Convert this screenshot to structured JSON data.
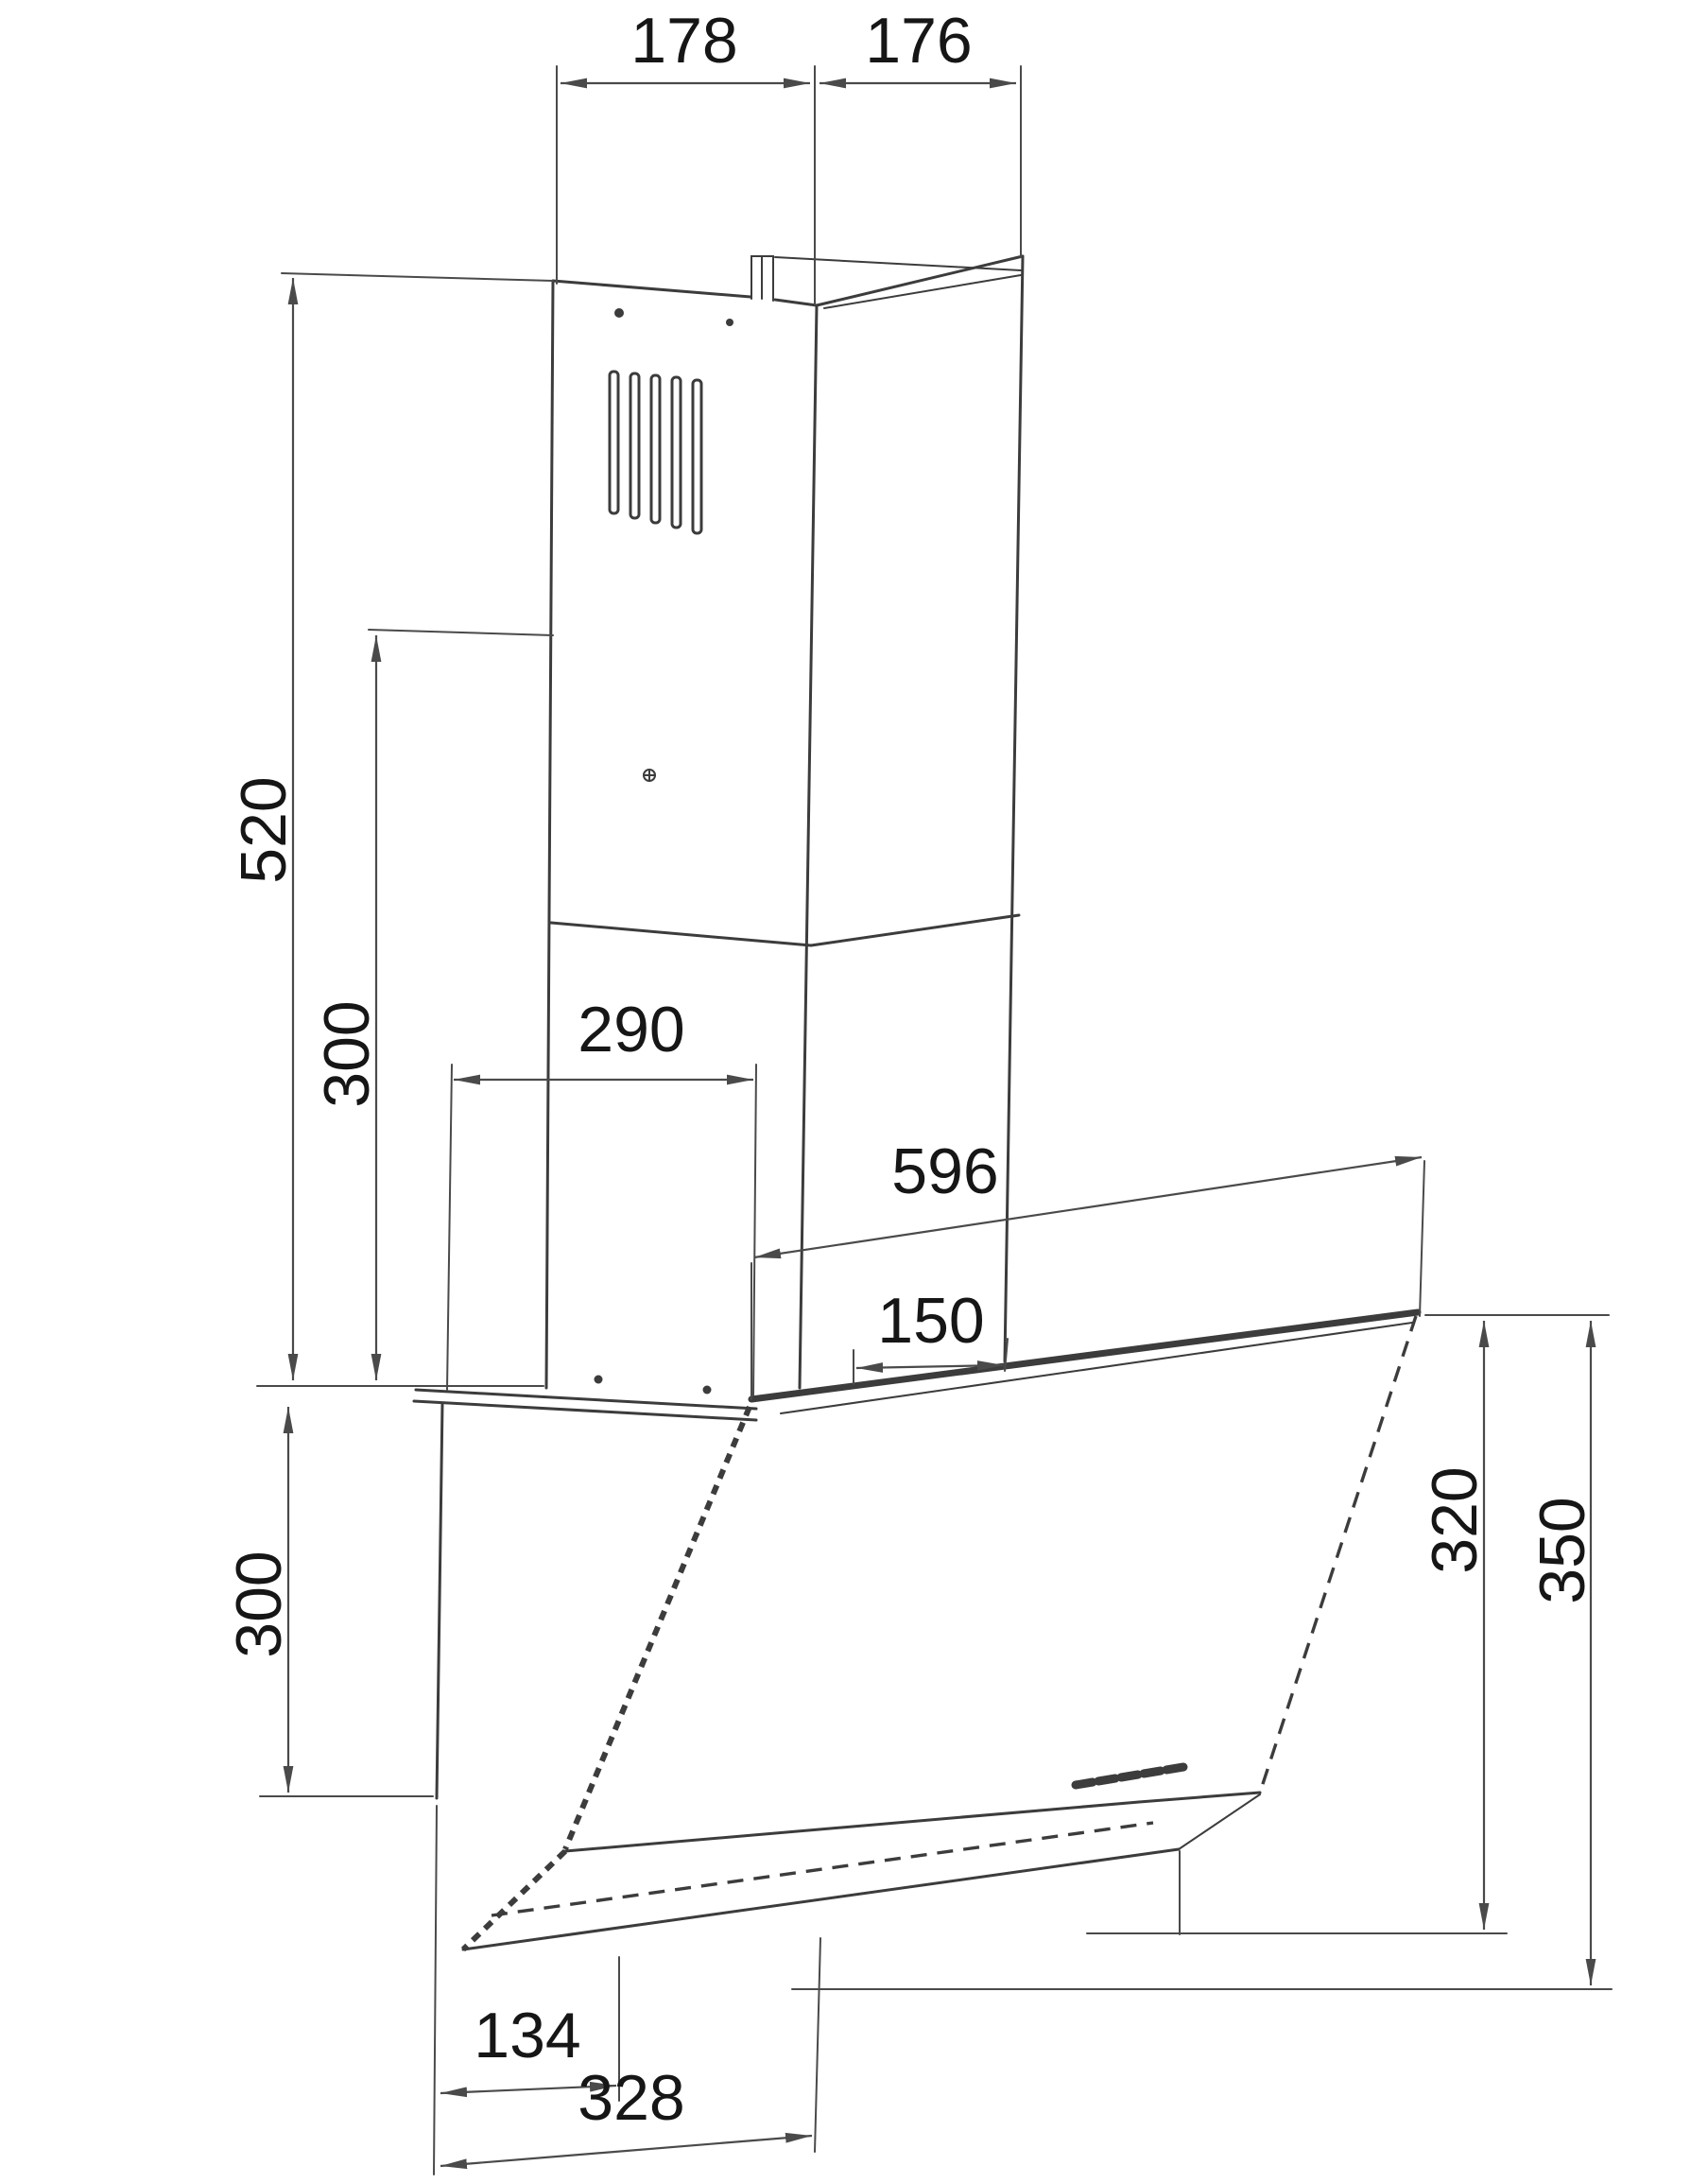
{
  "drawing": {
    "description": "Technical dimension drawing of a wall-mounted angled cooker hood with telescopic chimney",
    "background_color": "#ffffff",
    "line_color": "#3c3c3c",
    "label_color": "#161616",
    "dimensions": {
      "chimney_front_width": "178",
      "chimney_side_depth": "176",
      "chimney_upper_height": "520",
      "chimney_lower_height": "300",
      "mounting_bracket_width": "290",
      "hood_top_width": "596",
      "duct_outlet_offset": "150",
      "back_body_height": "300",
      "glass_panel_height": "320",
      "total_front_height": "350",
      "bottom_rear_depth": "134",
      "bottom_total_depth": "328"
    }
  }
}
